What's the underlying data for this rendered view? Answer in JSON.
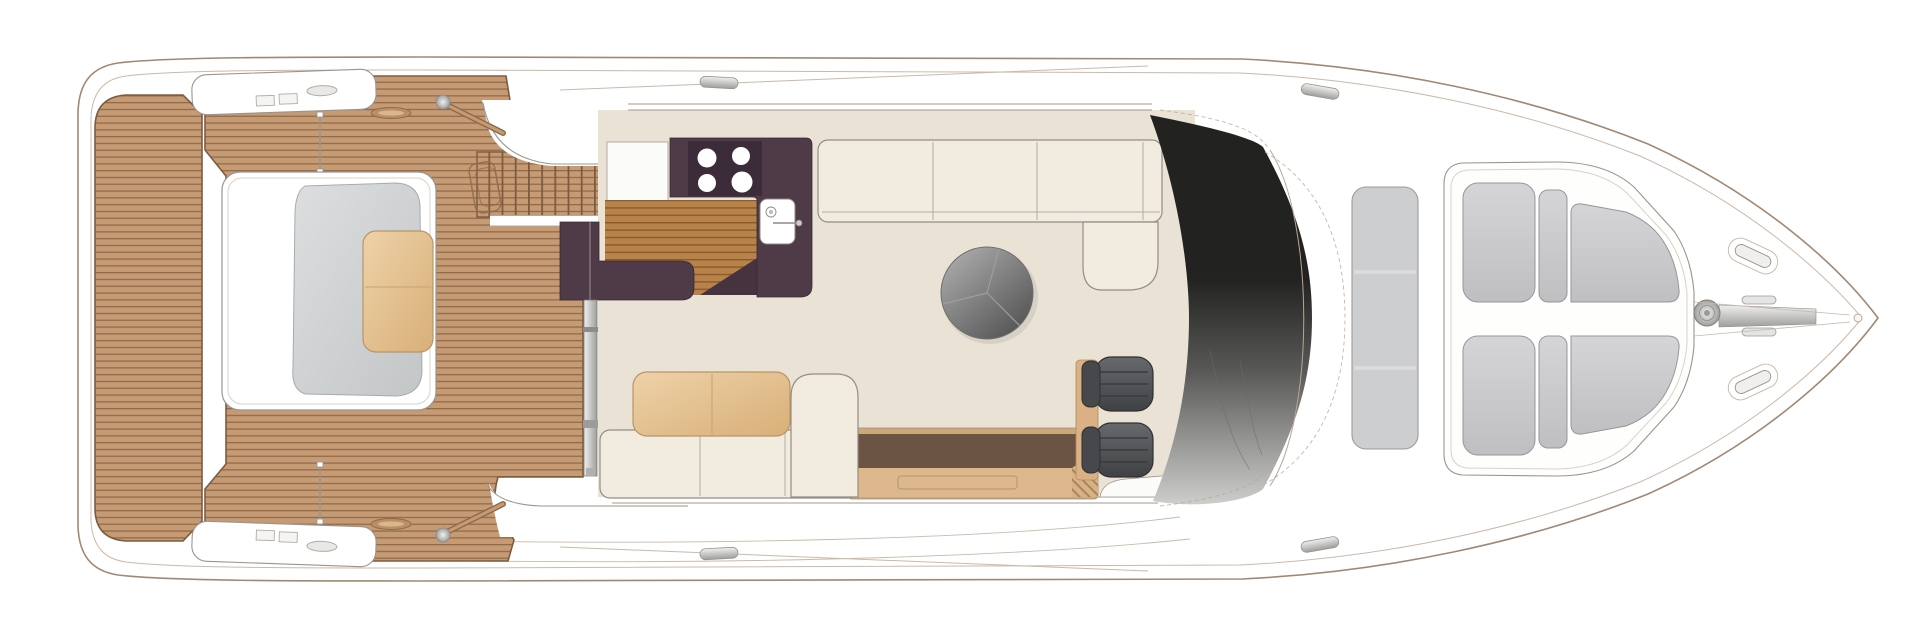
{
  "meta": {
    "title": "Motor yacht main deck floor plan",
    "type": "floor-plan",
    "canvas": {
      "width": 1920,
      "height": 637
    }
  },
  "colors": {
    "white": "#ffffff",
    "hull_stroke": "#a08874",
    "inner_line": "#cbb9a9",
    "outline_gray": "#9a948e",
    "glass_line": "#a39b8e",
    "teak": "#c69b74",
    "teak_line": "#8f6b4d",
    "teak_dark": "#7d5b3f",
    "galley_teak": "#b8834a",
    "galley_teak_line": "#8a5a28",
    "hatch_line": "#a5805b",
    "hatch_tan": "#d8b285",
    "cream": "#eae2d5",
    "sofa": "#f2ebe0",
    "sofa_stroke": "#938d83",
    "aubergine": "#4f3a47",
    "aubergine_dark": "#3c2b38",
    "tan_light": "#eed2a8",
    "tan_dark": "#d8af78",
    "table_light": "#b4b4b4",
    "table_dark": "#515151",
    "recess_brown": "#6b5443",
    "shelf_tan": "#ddb88d",
    "rim_tan": "#caa87e",
    "chair_light": "#67696c",
    "chair_dark": "#3f4144",
    "chair_back": "#46484b",
    "chair_stroke": "#2f3032",
    "windscreen_top": "#222220",
    "windscreen_mid": "#595957",
    "windscreen_bottom": "#cdcdcb",
    "cushion_light": "#d5d5d7",
    "cushion_dark": "#bfbfc1",
    "cushion_stroke": "#97979b",
    "sunpad": "#cdced0",
    "inset_light": "#dcdedf",
    "inset_dark": "#c3c6c7",
    "silver_light": "#f0f0ee",
    "silver_dark": "#9e9e9c"
  },
  "areas": {
    "hull": {
      "label": "Yacht hull, bow to the right"
    },
    "swim_platform": {
      "label": "Teak swim platform"
    },
    "aft_deck": {
      "label": "Teak aft deck"
    },
    "aft_seating": {
      "label": "Aft deck lounger with table"
    },
    "flybridge_stairs": {
      "label": "Steps up to flybridge"
    },
    "side_locker_top": {
      "label": "Port side locker"
    },
    "side_locker_bottom": {
      "label": "Starboard side locker"
    },
    "sliding_door": {
      "label": "Cockpit sliding door"
    },
    "galley": {
      "label": "Aft galley"
    },
    "hob": {
      "label": "Four burner hob"
    },
    "sink": {
      "label": "Galley sink"
    },
    "cockpit_sofa": {
      "label": "Cockpit sofa with table"
    },
    "saloon": {
      "label": "Saloon"
    },
    "saloon_sofa": {
      "label": "Saloon L-shaped sofa"
    },
    "saloon_table": {
      "label": "Round saloon table"
    },
    "sideboard": {
      "label": "Sideboard over companionway"
    },
    "companionway": {
      "label": "Steps down to lower deck"
    },
    "helm": {
      "label": "Helm station"
    },
    "helm_seats": {
      "label": "Twin helm seats"
    },
    "windscreen": {
      "label": "Raked windscreen"
    },
    "sun_pad": {
      "label": "Foredeck sun pad"
    },
    "bow_seating": {
      "label": "Bow V seating"
    },
    "windlass": {
      "label": "Anchor windlass and chain channel"
    }
  }
}
